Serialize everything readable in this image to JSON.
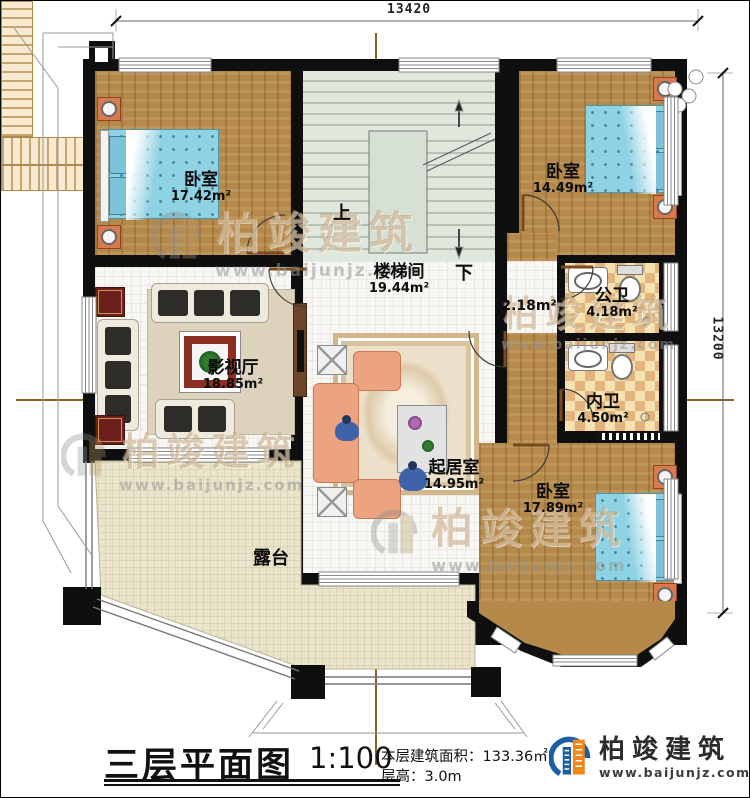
{
  "dimensions": {
    "top": "13420",
    "right": "13200"
  },
  "rooms": {
    "bedroom_tl": {
      "name": "卧室",
      "area": "17.42m²"
    },
    "bedroom_tr": {
      "name": "卧室",
      "area": "14.49m²"
    },
    "stairwell": {
      "name": "楼梯间",
      "area": "19.44m²"
    },
    "corridor": {
      "area": "2.18m²"
    },
    "public_bath": {
      "name": "公卫",
      "area": "4.18m²"
    },
    "private_bath": {
      "name": "内卫",
      "area": "4.50m²"
    },
    "media_room": {
      "name": "影视厅",
      "area": "18.85m²"
    },
    "living_room": {
      "name": "起居室",
      "area": "14.95m²"
    },
    "bedroom_br": {
      "name": "卧室",
      "area": "17.89m²"
    },
    "terrace": {
      "name": "露台"
    }
  },
  "stairs": {
    "up": "上",
    "down": "下"
  },
  "watermark": {
    "brand": "柏竣建筑",
    "url": "www.baijunjz.com"
  },
  "titleblock": {
    "title": "三层平面图",
    "scale": "1:100",
    "area_label": "本层建筑面积：",
    "area_value": "133.36㎡",
    "height_label": "层高：",
    "height_value": "3.0m"
  },
  "logo": {
    "brand": "柏竣建筑",
    "url": "www.baijunjz.com"
  },
  "colors": {
    "wall": "#0f0f0f",
    "wood": "#b5894a",
    "bath_tile": "#f0d6a2",
    "stair_floor": "#e0e8de",
    "terrace": "#ebe5cc",
    "bed": "#8ed2e4",
    "logo_blue": "#1b5ea6",
    "logo_orange": "#f08519"
  }
}
